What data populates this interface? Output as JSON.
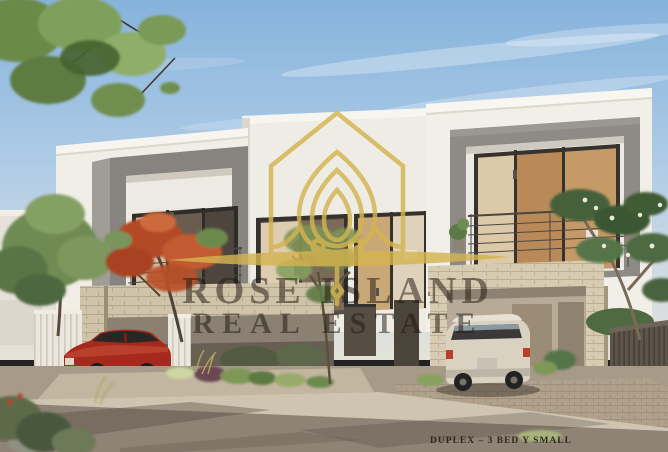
{
  "meta": {
    "description": "Architectural rendering of a modern two-storey duplex townhouse with grey balcony frames, stone-clad carports, a red sedan and a white SUV, trees and landscaping under a blue sky"
  },
  "watermark": {
    "logo_icon": "house-lotus-logo",
    "line1": "ROSE ISLAND",
    "line2": "REAL ESTATE",
    "gold": "#D4B450",
    "text_color": "rgba(32,25,18,0.52)"
  },
  "caption": {
    "text": "DUPLEX – 3 BED Y SMALL",
    "color": "#281D12"
  },
  "palette": {
    "sky_top": "#86B3DC",
    "sky_horizon": "#DCE2DE",
    "facade_white": "#F1EEE7",
    "frame_gray": "#8B8883",
    "stone": "#CFC3A9",
    "road": "#8F8376",
    "foliage_green": "#6F8A52",
    "flame_tree_red": "#B84A28",
    "car_red": "#A5291D",
    "car_white": "#D9D2C2"
  }
}
